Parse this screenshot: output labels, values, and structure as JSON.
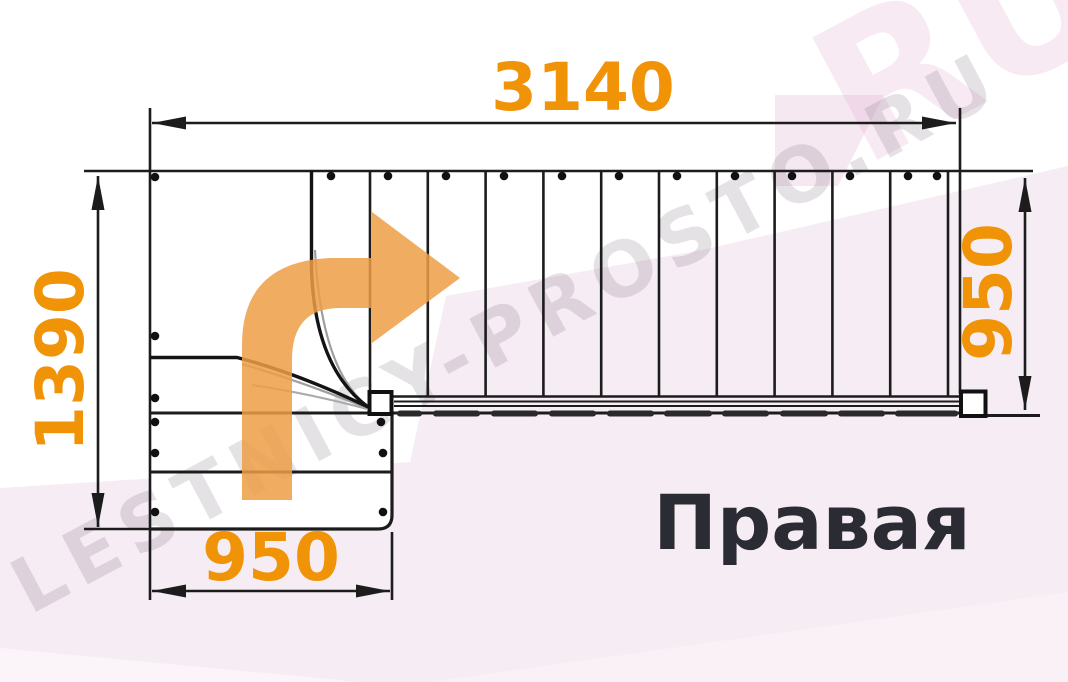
{
  "diagram": {
    "title": "Правая",
    "watermark": "LESTNICY-PROSTO.RU",
    "watermark_corner_fragment": "RU",
    "dimensions": {
      "top_width": "3140",
      "left_height": "1390",
      "bottom_width": "950",
      "right_width": "950"
    },
    "stair": {
      "type": "L-shaped winder staircase plan",
      "turn_direction": "right",
      "straight_flight_treads": 10,
      "winder_treads": 3,
      "lower_flight_treads": 2
    },
    "colors": {
      "dimension_accent": "#F09307",
      "arrow_fill": "#ED9E45",
      "line": "#1C1C1C",
      "background_tint": "#F6ECF3",
      "title_color": "#2B2B33"
    }
  }
}
